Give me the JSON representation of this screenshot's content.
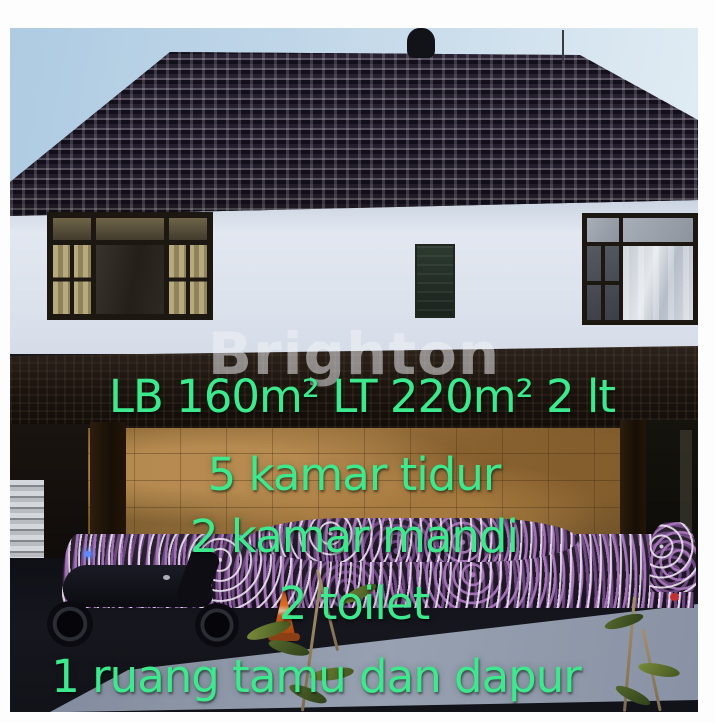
{
  "photo": {
    "watermark": "Brighton"
  },
  "overlay": {
    "lines": [
      {
        "text": "LB 160m² LT 220m² 2 lt"
      },
      {
        "text": "5 kamar tidur"
      },
      {
        "text": "2 kamar mandi"
      },
      {
        "text": "2 toilet"
      },
      {
        "text": "1 ruang tamu dan dapur"
      }
    ]
  },
  "palette": {
    "overlay-green": "#3ce98d",
    "watermark-white": "rgba(242,242,246,0.52)"
  }
}
